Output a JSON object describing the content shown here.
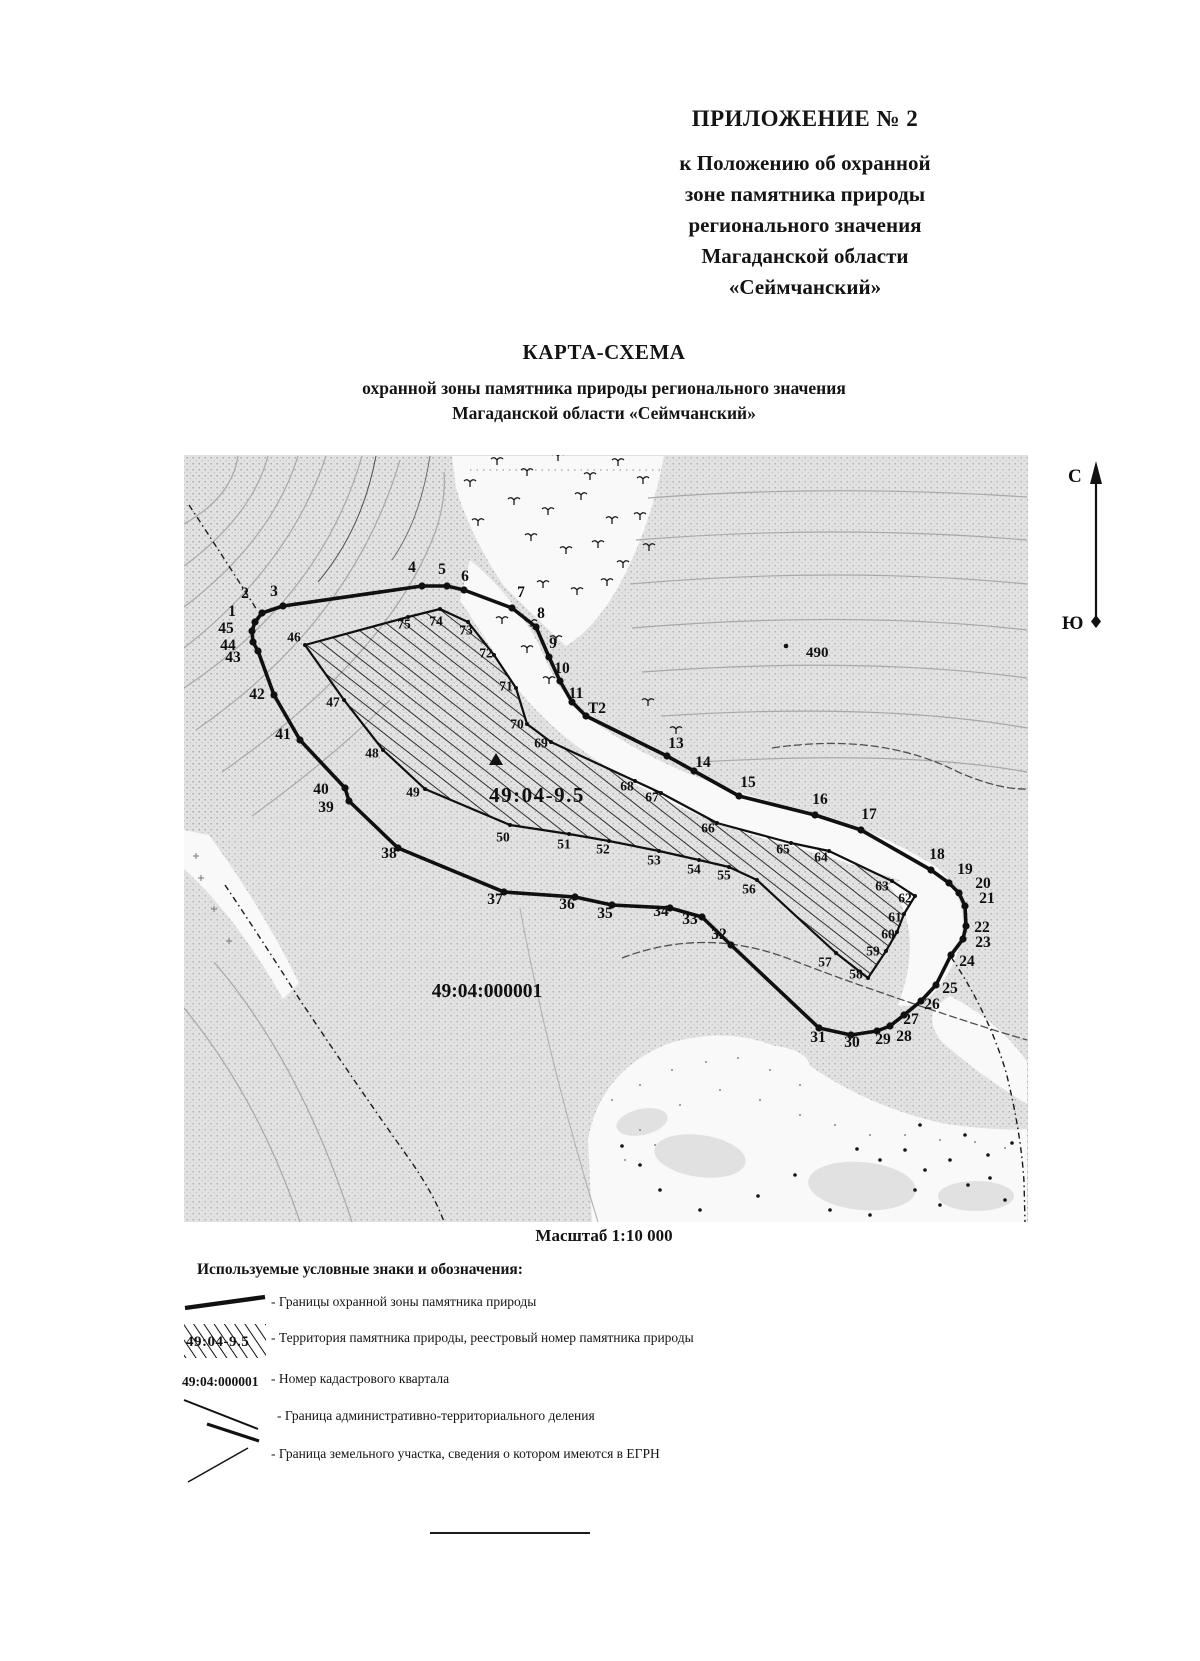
{
  "page": {
    "appendix_title": "ПРИЛОЖЕНИЕ № 2",
    "appendix_subtitle_lines": [
      "к Положению об охранной",
      "зоне памятника природы",
      "регионального значения",
      "Магаданской области",
      "«Сеймчанский»"
    ],
    "map_heading": "КАРТА-СХЕМА",
    "map_subheading_lines": [
      "охранной зоны памятника природы регионального значения",
      "Магаданской области «Сеймчанский»"
    ],
    "scale_label": "Масштаб 1:10 000"
  },
  "map": {
    "north_label": "С",
    "south_label": "Ю",
    "registry_number": {
      "text": "49:04-9.5"
    },
    "cadastral_number": {
      "text": "49:04:000001"
    },
    "elevation_point": {
      "text": "490"
    },
    "outer_boundary_points": [
      {
        "n": "1",
        "x": 255,
        "y": 622,
        "lx": 232,
        "ly": 611
      },
      {
        "n": "2",
        "x": 262,
        "y": 613,
        "lx": 245,
        "ly": 593
      },
      {
        "n": "3",
        "x": 283,
        "y": 606,
        "lx": 274,
        "ly": 591
      },
      {
        "n": "4",
        "x": 422,
        "y": 586,
        "lx": 412,
        "ly": 567
      },
      {
        "n": "5",
        "x": 447,
        "y": 586,
        "lx": 442,
        "ly": 569
      },
      {
        "n": "6",
        "x": 464,
        "y": 590,
        "lx": 465,
        "ly": 576
      },
      {
        "n": "7",
        "x": 512,
        "y": 608,
        "lx": 521,
        "ly": 592
      },
      {
        "n": "8",
        "x": 536,
        "y": 627,
        "lx": 541,
        "ly": 613
      },
      {
        "n": "9",
        "x": 549,
        "y": 657,
        "lx": 553,
        "ly": 643
      },
      {
        "n": "10",
        "x": 560,
        "y": 681,
        "lx": 562,
        "ly": 668
      },
      {
        "n": "11",
        "x": 572,
        "y": 702,
        "lx": 576,
        "ly": 693
      },
      {
        "n": "Т2",
        "x": 586,
        "y": 716,
        "lx": 597,
        "ly": 708
      },
      {
        "n": "13",
        "x": 667,
        "y": 756,
        "lx": 676,
        "ly": 743
      },
      {
        "n": "14",
        "x": 694,
        "y": 771,
        "lx": 703,
        "ly": 762
      },
      {
        "n": "15",
        "x": 739,
        "y": 796,
        "lx": 748,
        "ly": 782
      },
      {
        "n": "16",
        "x": 815,
        "y": 815,
        "lx": 820,
        "ly": 799
      },
      {
        "n": "17",
        "x": 861,
        "y": 830,
        "lx": 869,
        "ly": 814
      },
      {
        "n": "18",
        "x": 931,
        "y": 870,
        "lx": 937,
        "ly": 854
      },
      {
        "n": "19",
        "x": 949,
        "y": 883,
        "lx": 965,
        "ly": 869
      },
      {
        "n": "20",
        "x": 959,
        "y": 893,
        "lx": 983,
        "ly": 883
      },
      {
        "n": "21",
        "x": 965,
        "y": 906,
        "lx": 987,
        "ly": 898
      },
      {
        "n": "22",
        "x": 966,
        "y": 926,
        "lx": 982,
        "ly": 927
      },
      {
        "n": "23",
        "x": 963,
        "y": 939,
        "lx": 983,
        "ly": 942
      },
      {
        "n": "24",
        "x": 951,
        "y": 955,
        "lx": 967,
        "ly": 961
      },
      {
        "n": "25",
        "x": 936,
        "y": 985,
        "lx": 950,
        "ly": 988
      },
      {
        "n": "26",
        "x": 921,
        "y": 1001,
        "lx": 932,
        "ly": 1004
      },
      {
        "n": "27",
        "x": 904,
        "y": 1015,
        "lx": 911,
        "ly": 1019
      },
      {
        "n": "28",
        "x": 890,
        "y": 1026,
        "lx": 904,
        "ly": 1036
      },
      {
        "n": "29",
        "x": 877,
        "y": 1031,
        "lx": 883,
        "ly": 1039
      },
      {
        "n": "30",
        "x": 851,
        "y": 1035,
        "lx": 852,
        "ly": 1042
      },
      {
        "n": "31",
        "x": 819,
        "y": 1028,
        "lx": 818,
        "ly": 1037
      },
      {
        "n": "32",
        "x": 731,
        "y": 945,
        "lx": 719,
        "ly": 934
      },
      {
        "n": "33",
        "x": 702,
        "y": 917,
        "lx": 690,
        "ly": 919
      },
      {
        "n": "34",
        "x": 670,
        "y": 908,
        "lx": 661,
        "ly": 911
      },
      {
        "n": "35",
        "x": 612,
        "y": 905,
        "lx": 605,
        "ly": 913
      },
      {
        "n": "36",
        "x": 575,
        "y": 897,
        "lx": 567,
        "ly": 904
      },
      {
        "n": "37",
        "x": 504,
        "y": 892,
        "lx": 495,
        "ly": 899
      },
      {
        "n": "38",
        "x": 398,
        "y": 848,
        "lx": 389,
        "ly": 853
      },
      {
        "n": "39",
        "x": 349,
        "y": 801,
        "lx": 326,
        "ly": 807
      },
      {
        "n": "40",
        "x": 345,
        "y": 788,
        "lx": 321,
        "ly": 789
      },
      {
        "n": "41",
        "x": 300,
        "y": 740,
        "lx": 283,
        "ly": 734
      },
      {
        "n": "42",
        "x": 274,
        "y": 695,
        "lx": 257,
        "ly": 694
      },
      {
        "n": "43",
        "x": 258,
        "y": 651,
        "lx": 233,
        "ly": 657
      },
      {
        "n": "44",
        "x": 253,
        "y": 642,
        "lx": 228,
        "ly": 645
      },
      {
        "n": "45",
        "x": 252,
        "y": 631,
        "lx": 226,
        "ly": 628
      }
    ],
    "territory_points": [
      {
        "n": "46",
        "x": 305,
        "y": 645,
        "lx": 294,
        "ly": 637
      },
      {
        "n": "47",
        "x": 344,
        "y": 700,
        "lx": 333,
        "ly": 702
      },
      {
        "n": "48",
        "x": 383,
        "y": 750,
        "lx": 372,
        "ly": 753
      },
      {
        "n": "49",
        "x": 425,
        "y": 789,
        "lx": 413,
        "ly": 792
      },
      {
        "n": "50",
        "x": 510,
        "y": 825,
        "lx": 503,
        "ly": 837
      },
      {
        "n": "51",
        "x": 569,
        "y": 834,
        "lx": 564,
        "ly": 844
      },
      {
        "n": "52",
        "x": 609,
        "y": 841,
        "lx": 603,
        "ly": 849
      },
      {
        "n": "53",
        "x": 659,
        "y": 851,
        "lx": 654,
        "ly": 860
      },
      {
        "n": "54",
        "x": 699,
        "y": 860,
        "lx": 694,
        "ly": 869
      },
      {
        "n": "55",
        "x": 729,
        "y": 867,
        "lx": 724,
        "ly": 875
      },
      {
        "n": "56",
        "x": 757,
        "y": 880,
        "lx": 749,
        "ly": 889
      },
      {
        "n": "57",
        "x": 836,
        "y": 953,
        "lx": 825,
        "ly": 962
      },
      {
        "n": "58",
        "x": 868,
        "y": 978,
        "lx": 856,
        "ly": 974
      },
      {
        "n": "59",
        "x": 886,
        "y": 951,
        "lx": 873,
        "ly": 951
      },
      {
        "n": "60",
        "x": 897,
        "y": 932,
        "lx": 888,
        "ly": 934
      },
      {
        "n": "61",
        "x": 904,
        "y": 914,
        "lx": 895,
        "ly": 917
      },
      {
        "n": "62",
        "x": 915,
        "y": 896,
        "lx": 905,
        "ly": 898
      },
      {
        "n": "63",
        "x": 892,
        "y": 881,
        "lx": 882,
        "ly": 886
      },
      {
        "n": "64",
        "x": 829,
        "y": 851,
        "lx": 821,
        "ly": 857
      },
      {
        "n": "65",
        "x": 791,
        "y": 843,
        "lx": 783,
        "ly": 849
      },
      {
        "n": "66",
        "x": 717,
        "y": 823,
        "lx": 708,
        "ly": 828
      },
      {
        "n": "67",
        "x": 661,
        "y": 793,
        "lx": 652,
        "ly": 797
      },
      {
        "n": "68",
        "x": 635,
        "y": 781,
        "lx": 627,
        "ly": 786
      },
      {
        "n": "69",
        "x": 551,
        "y": 742,
        "lx": 541,
        "ly": 743
      },
      {
        "n": "70",
        "x": 527,
        "y": 724,
        "lx": 517,
        "ly": 724
      },
      {
        "n": "71",
        "x": 516,
        "y": 688,
        "lx": 506,
        "ly": 686
      },
      {
        "n": "72",
        "x": 494,
        "y": 655,
        "lx": 486,
        "ly": 653
      },
      {
        "n": "73",
        "x": 468,
        "y": 622,
        "lx": 466,
        "ly": 630
      },
      {
        "n": "74",
        "x": 440,
        "y": 609,
        "lx": 436,
        "ly": 621
      },
      {
        "n": "75",
        "x": 408,
        "y": 617,
        "lx": 404,
        "ly": 624
      }
    ]
  },
  "legend": {
    "heading": "Используемые условные знаки и обозначения:",
    "items": [
      {
        "symbol": "protection-zone-line",
        "label": "- Границы охранной зоны памятника природы"
      },
      {
        "symbol": "territory-hatch",
        "symbol_text": "49:04-9.5",
        "label": "- Территория памятника природы, реестровый номер памятника природы"
      },
      {
        "symbol": "cadastral-number",
        "symbol_text": "49:04:000001",
        "label": "- Номер кадастрового квартала"
      },
      {
        "symbol": "admin-boundary-line",
        "label": "- Граница административно-территориального деления"
      },
      {
        "symbol": "parcel-boundary-line",
        "label": "- Граница земельного участка, сведения о котором имеются в ЕГРН"
      }
    ]
  },
  "colors": {
    "ink": "#141414",
    "terrain_base": "#e2e2e2",
    "stipple": "#9f9f9f",
    "contour": "#a8a8a8",
    "dark_contour": "#4f4f4f",
    "white_area": "#f9f9f9"
  }
}
